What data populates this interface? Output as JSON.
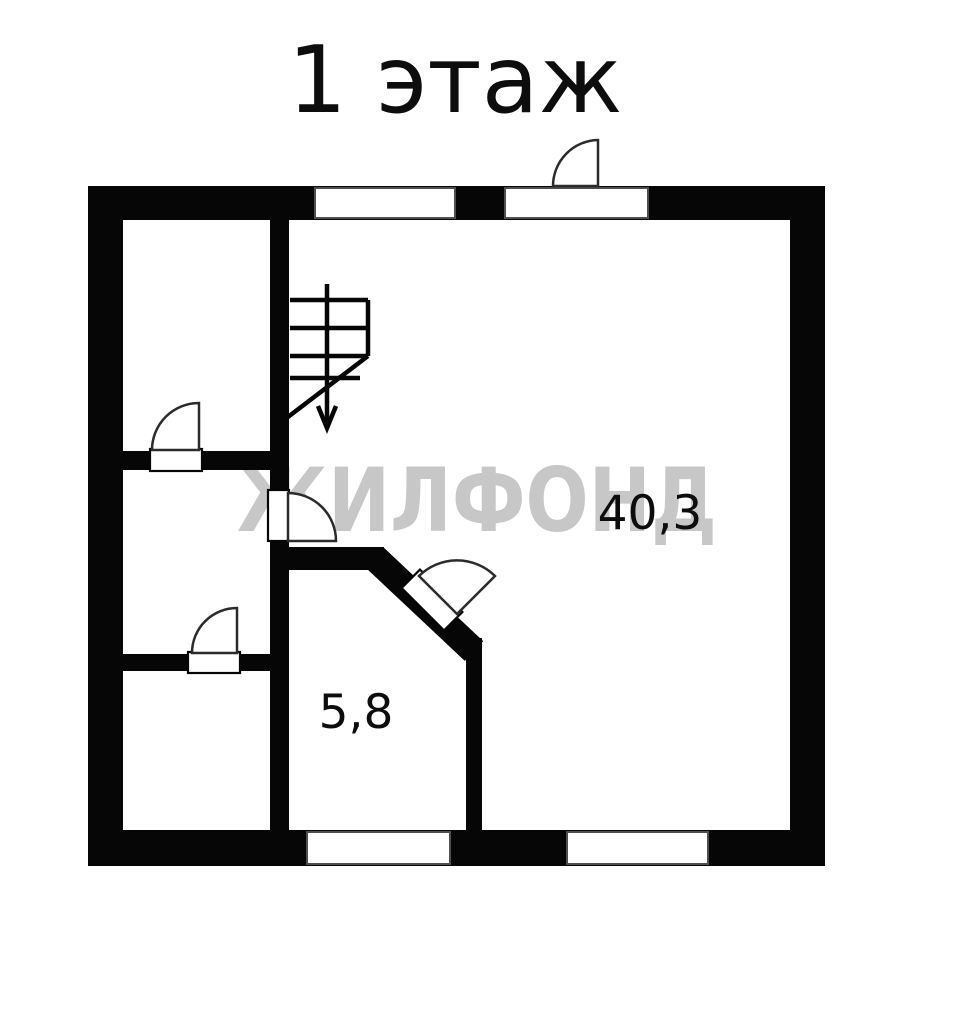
{
  "title": "1 этаж",
  "watermark": {
    "text": "ЖИЛФОНД",
    "color": "#c7c7c7"
  },
  "rooms": {
    "main_room": {
      "area": "40,3"
    },
    "small_room": {
      "area": "5,8"
    }
  },
  "colors": {
    "wall": "#060606",
    "background": "#ffffff",
    "door_line": "#2b2b2b",
    "window_border": "#4f4f4f",
    "label": "#0d0d0d"
  }
}
